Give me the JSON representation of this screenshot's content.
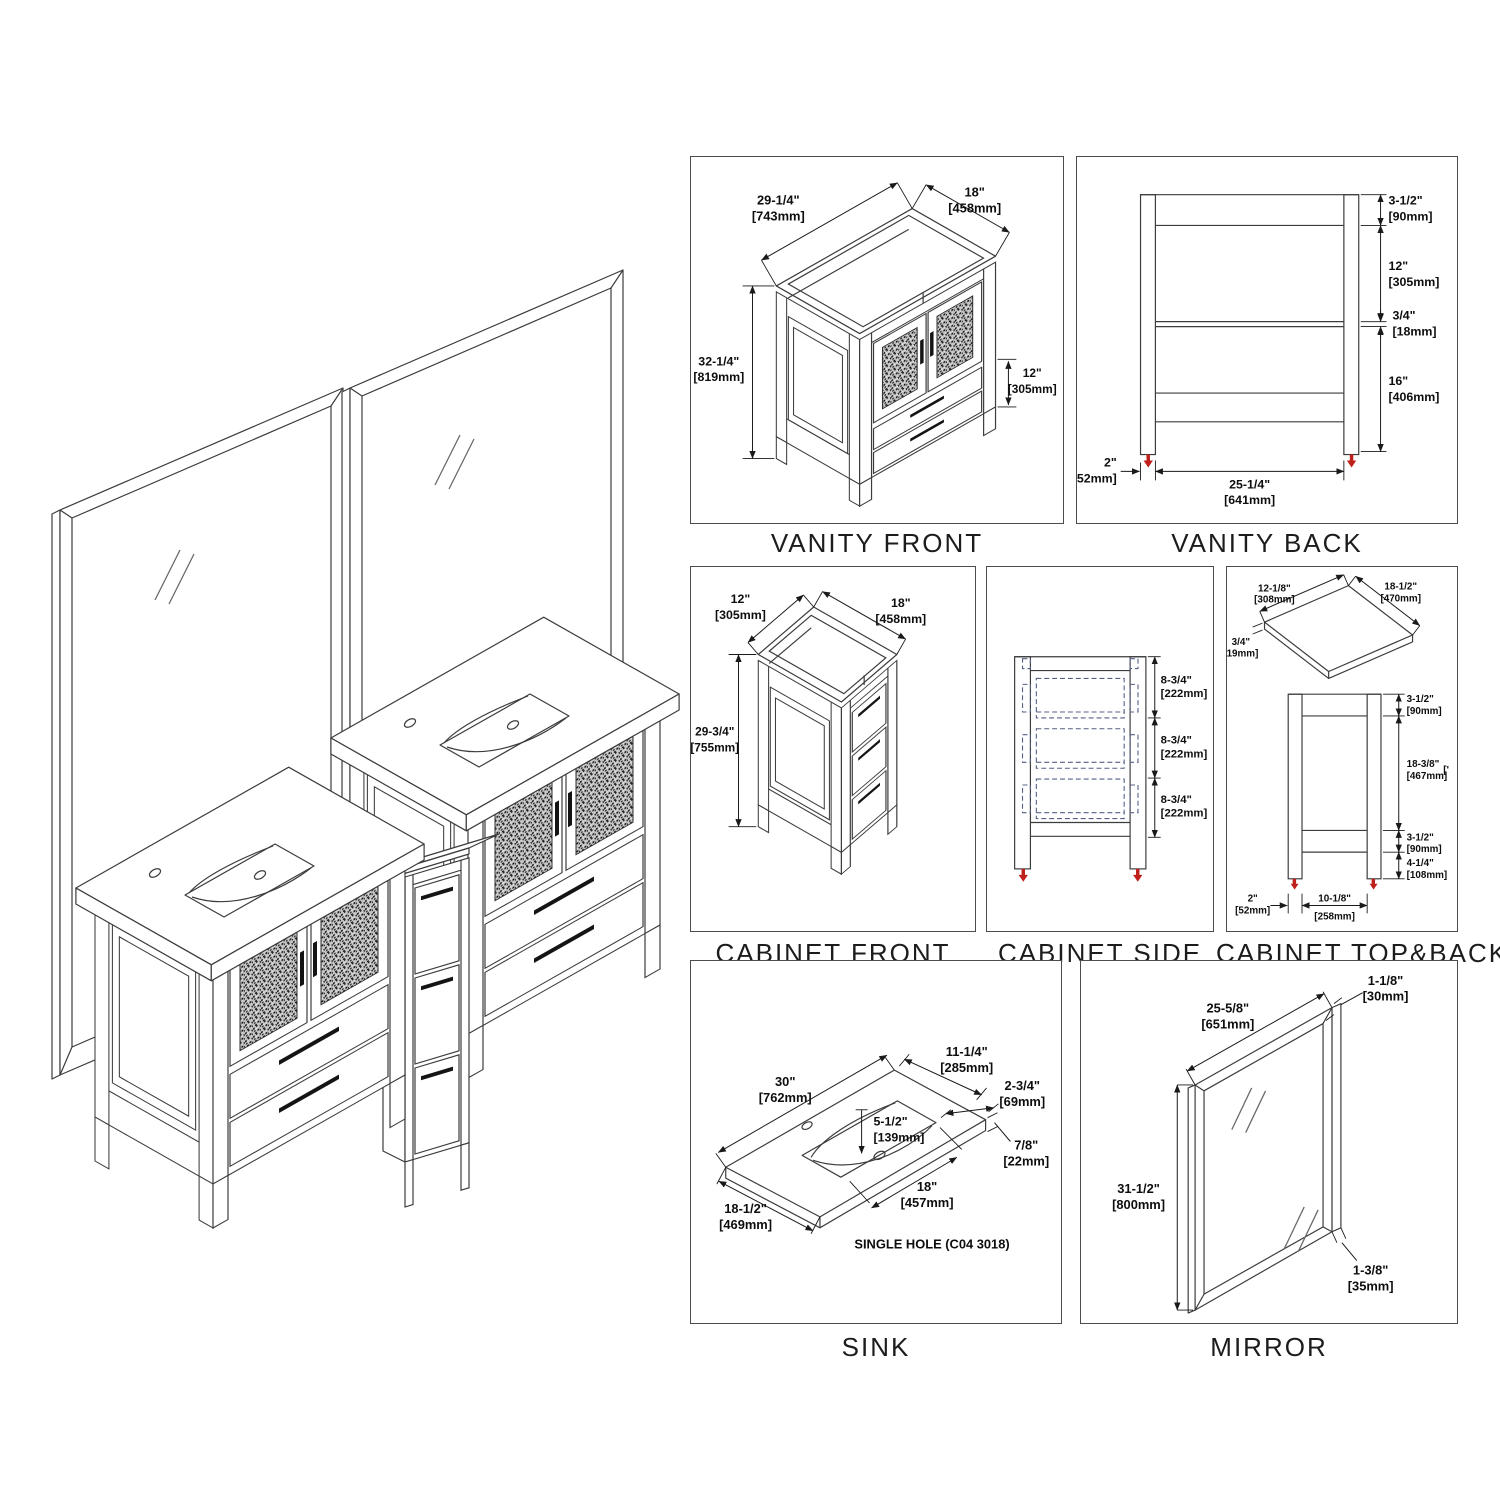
{
  "illustration": {
    "name": "vanity-set-isometric-view"
  },
  "panels": {
    "vanity_front": {
      "title": "VANITY FRONT",
      "dims": {
        "width": {
          "in": "29-1/4\"",
          "mm": "[743mm]"
        },
        "depth": {
          "in": "18\"",
          "mm": "[458mm]"
        },
        "height": {
          "in": "32-1/4\"",
          "mm": "[819mm]"
        },
        "drawer_section": {
          "in": "12\"",
          "mm": "[305mm]"
        }
      }
    },
    "vanity_back": {
      "title": "VANITY BACK",
      "dims": {
        "top_rail": {
          "in": "3-1/2\"",
          "mm": "[90mm]"
        },
        "door_opening": {
          "in": "12\"",
          "mm": "[305mm]"
        },
        "shelf": {
          "in": "3/4\"",
          "mm": "[18mm]"
        },
        "lower_opening": {
          "in": "16\"",
          "mm": "[406mm]"
        },
        "leg_width": {
          "in": "2\"",
          "mm": "[52mm]"
        },
        "inner_width": {
          "in": "25-1/4\"",
          "mm": "[641mm]"
        }
      }
    },
    "cabinet_front": {
      "title": "CABINET FRONT",
      "dims": {
        "width": {
          "in": "12\"",
          "mm": "[305mm]"
        },
        "depth": {
          "in": "18\"",
          "mm": "[458mm]"
        },
        "height": {
          "in": "29-3/4\"",
          "mm": "[755mm]"
        }
      }
    },
    "cabinet_side": {
      "title": "CABINET SIDE",
      "dims": {
        "drawer1": {
          "in": "8-3/4\"",
          "mm": "[222mm]"
        },
        "drawer2": {
          "in": "8-3/4\"",
          "mm": "[222mm]"
        },
        "drawer3": {
          "in": "8-3/4\"",
          "mm": "[222mm]"
        }
      }
    },
    "cabinet_top_back": {
      "title": "CABINET TOP&BACK",
      "stray_mark": "['",
      "dims": {
        "top_width": {
          "in": "12-1/8\"",
          "mm": "[308mm]"
        },
        "top_depth": {
          "in": "18-1/2\"",
          "mm": "[470mm]"
        },
        "top_thickness": {
          "in": "3/4\"",
          "mm": "[19mm]"
        },
        "top_rail": {
          "in": "3-1/2\"",
          "mm": "[90mm]"
        },
        "opening": {
          "in": "18-3/8\"",
          "mm": "[467mm]"
        },
        "bottom_rail": {
          "in": "3-1/2\"",
          "mm": "[90mm]"
        },
        "leg_height": {
          "in": "4-1/4\"",
          "mm": "[108mm]"
        },
        "leg_width": {
          "in": "2\"",
          "mm": "[52mm]"
        },
        "inner_width": {
          "in": "10-1/8\"",
          "mm": "[258mm]"
        }
      }
    },
    "sink": {
      "title": "SINK",
      "note": "SINGLE HOLE (C04 3018)",
      "dims": {
        "width": {
          "in": "30\"",
          "mm": "[762mm]"
        },
        "back_ledge": {
          "in": "11-1/4\"",
          "mm": "[285mm]"
        },
        "corner": {
          "in": "2-3/4\"",
          "mm": "[69mm]"
        },
        "thickness": {
          "in": "7/8\"",
          "mm": "[22mm]"
        },
        "basin_depth": {
          "in": "5-1/2\"",
          "mm": "[139mm]"
        },
        "basin_width": {
          "in": "18\"",
          "mm": "[457mm]"
        },
        "depth": {
          "in": "18-1/2\"",
          "mm": "[469mm]"
        }
      }
    },
    "mirror": {
      "title": "MIRROR",
      "dims": {
        "frame": {
          "in": "1-1/8\"",
          "mm": "[30mm]"
        },
        "width": {
          "in": "25-5/8\"",
          "mm": "[651mm]"
        },
        "height": {
          "in": "31-1/2\"",
          "mm": "[800mm]"
        },
        "depth": {
          "in": "1-3/8\"",
          "mm": "[35mm]"
        }
      }
    }
  }
}
